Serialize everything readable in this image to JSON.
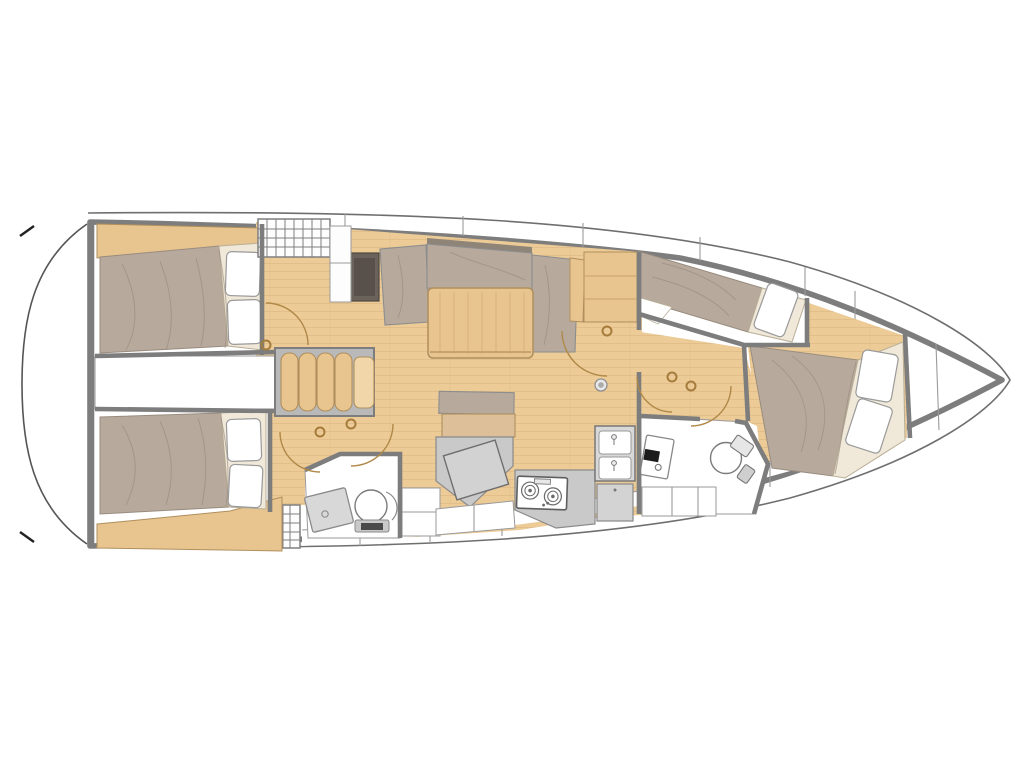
{
  "meta": {
    "title": "Sailing yacht interior layout floor plan, top view, bow pointing right"
  },
  "colors": {
    "white": "#ffffff",
    "hull": "#7d7d7d",
    "hull_outer": "#6f6f6f",
    "wall": "#7d7d7d",
    "room_line": "#9a9a9a",
    "wood_floor": "#eccb97",
    "wood_grain": "#d8b37d",
    "wood_furniture": "#e8c48e",
    "wood_furniture_light": "#f0d6a8",
    "wood_edge": "#b08f5e",
    "upholstery": "#b7aa9d",
    "upholstery_shadow": "#998c7f",
    "cushion_trim": "#8f8478",
    "cream": "#f0e8d8",
    "cream_edge": "#b9ae97",
    "pillow": "#ffffff",
    "pillow_edge": "#9a9a9a",
    "fixture": "#d8d8d8",
    "counter": "#c9c9c9",
    "counter_dark": "#a9a9a9",
    "dark_cabinet": "#6b635b",
    "dark_cabinet_inner": "#58514b",
    "door": "#b08948",
    "hinge": "#a57c3c",
    "grid": "#7f7f7f"
  },
  "features": {
    "orientation": "bow-right",
    "cabins": [
      {
        "id": "aft-cabin-port",
        "berth": "double-bed",
        "pillows": 2
      },
      {
        "id": "aft-cabin-starboard",
        "berth": "double-bed",
        "pillows": 2
      },
      {
        "id": "pullman-berth-forward",
        "berth": "single-bed",
        "pillows": 1
      },
      {
        "id": "forward-cabin",
        "berth": "double-bed",
        "pillows": 2
      }
    ],
    "heads": [
      {
        "id": "aft-head",
        "fixtures": [
          "toilet",
          "sink"
        ]
      },
      {
        "id": "forward-head",
        "fixtures": [
          "toilet",
          "sink"
        ]
      }
    ],
    "salon": {
      "items": [
        "u-shaped-settee",
        "dining-table",
        "storage-cabinet"
      ]
    },
    "galley": {
      "stove_burners": 2,
      "sink_basins": 2
    },
    "nav_station": {
      "items": [
        "seat",
        "chart-table"
      ]
    },
    "companionway": {
      "step_count": 4,
      "hatch_grids": 2
    },
    "bow": {
      "items": [
        "anchor-locker"
      ]
    },
    "doors_with_swing_arcs": 6
  }
}
